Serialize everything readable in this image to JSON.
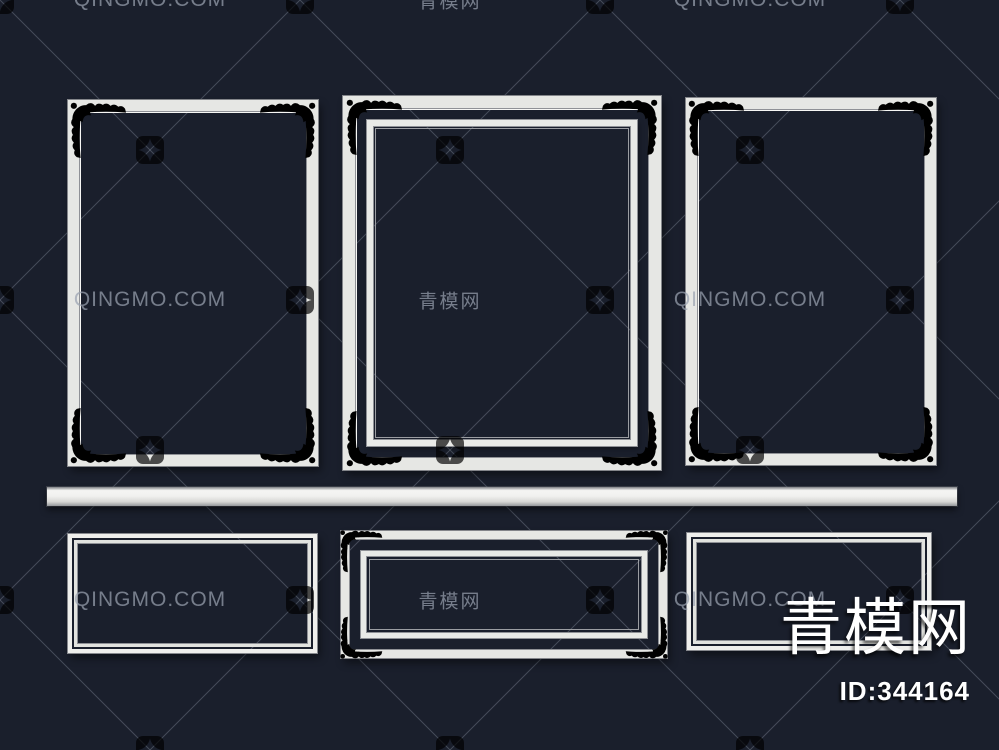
{
  "image": {
    "kind": "3d-model-preview-render",
    "subject": "white decorative wall molding frames on dark navy wall",
    "width_px": 999,
    "height_px": 750
  },
  "watermark": {
    "latin_text": "QINGMO.COM",
    "cjk_text": "青模网",
    "logo_icon": "qingmo-pinwheel-icon",
    "grid": {
      "text_rows_y": [
        0,
        300,
        600
      ],
      "logo_rows_y": [
        150,
        450,
        750
      ],
      "latin_cols_x": [
        150,
        750
      ],
      "cjk_cols_x": [
        450
      ],
      "logo_cols_x": [
        0,
        300,
        600,
        900
      ],
      "logo_mid_cols_x": [
        150,
        450,
        750
      ],
      "diagonal_spacing": 300
    }
  },
  "brand": {
    "logo_text": "青模网",
    "id_label": "ID:344164"
  },
  "colors": {
    "background": "#1a1f2c",
    "molding_white": "#e9eae7",
    "molding_highlight": "#f6f6f4",
    "molding_shadow": "#94969b",
    "watermark_gray": "#9aa2b0",
    "brand_white": "#ffffff"
  }
}
